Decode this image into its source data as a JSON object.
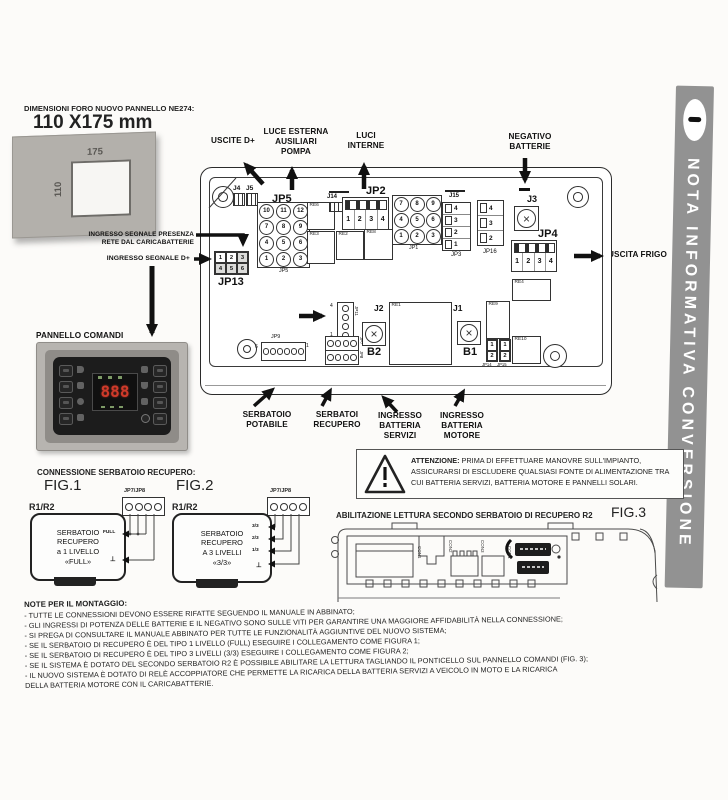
{
  "banner": {
    "title": "NOTA INFORMATIVA CONVERSIONE"
  },
  "colors": {
    "banner_bg": "#929292",
    "display_red": "#cf3a2a",
    "panel_black": "#1c1c1c",
    "frame_gray": "#b5b2ae",
    "ink": "#111111"
  },
  "dims": {
    "heading": "DIMENSIONI FORO NUOVO PANNELLO NE274:",
    "size": "110 X175 mm",
    "hole_w": "175",
    "hole_h": "110"
  },
  "callouts": {
    "uscite_d": "USCITE D+",
    "luce_esterna": "LUCE ESTERNA\nAUSILIARI\nPOMPA",
    "luci_interne": "LUCI\nINTERNE",
    "negativo_batterie": "NEGATIVO\nBATTERIE",
    "presenza": "INGRESSO SEGNALE PRESENZA\nRETE DAL CARICABATTERIE",
    "segnale_d": "INGRESSO SEGNALE D+",
    "uscita_frigo": "USCITA FRIGO",
    "cavo_seriale": "CAVO SERIALE",
    "pannello_comandi": "PANNELLO COMANDI",
    "serbatoio_potabile": "SERBATOIO\nPOTABILE",
    "serbatoi_recupero": "SERBATOI\nRECUPERO",
    "ingresso_batteria_servizi": "INGRESSO\nBATTERIA\nSERVIZI",
    "ingresso_batteria_motore": "INGRESSO\nBATTERIA\nMOTORE"
  },
  "board": {
    "j4": "J4",
    "j5": "J5",
    "jp5_big": "JP5",
    "jp5_small": "JP5",
    "jp5_cells": [
      "10",
      "11",
      "12",
      "7",
      "8",
      "9",
      "4",
      "5",
      "6",
      "1",
      "2",
      "3"
    ],
    "j14": "J14",
    "jp2": "JP2",
    "jp2_cells": [
      "1",
      "2",
      "3",
      "4"
    ],
    "jp1": "JP1",
    "jp1_cells": [
      "7",
      "8",
      "9",
      "4",
      "5",
      "6",
      "1",
      "2",
      "3"
    ],
    "j15": "J15",
    "jp3": "JP3",
    "jp3_cells": [
      "4",
      "3",
      "2",
      "1"
    ],
    "jp16": "JP16",
    "jp16_cells": [
      "4",
      "3",
      "2"
    ],
    "j3": "J3",
    "jp4": "JP4",
    "jp4_cells": [
      "1",
      "2",
      "3",
      "4"
    ],
    "re1": "RE1",
    "re2": "RE2",
    "re3": "RE3",
    "re4": "RE4",
    "re6": "RE6",
    "re8": "RE8",
    "re9": "RE9",
    "re10": "RE10",
    "jp13": "JP13",
    "jp13_cells": [
      "1",
      "2",
      "3",
      "4",
      "5",
      "6"
    ],
    "jp11": "JP11",
    "jp11_pin_top": "4",
    "jp11_pin_bottom": "1",
    "jp9": "JP9",
    "jp9_pin_left": "6",
    "jp9_pin_right": "1",
    "jp7": "JP7",
    "jp8": "JP8",
    "j2": "J2",
    "b2": "B2",
    "j1": "J1",
    "b1": "B1",
    "jp14": "JP14",
    "jp14_cells": [
      "1",
      "2"
    ],
    "jp15": "JP15",
    "jp15_cells": [
      "1",
      "2"
    ]
  },
  "panel": {
    "display": "888"
  },
  "warning": {
    "bold": "ATTENZIONE:",
    "rest": " PRIMA DI EFFETTUARE MANOVRE SULL'IMPIANTO, ASSICURARSI DI ESCLUDERE QUALSIASI FONTE DI ALIMENTAZIONE TRA CUI BATTERIA SERVIZI, BATTERIA MOTORE E PANNELLI SOLARI."
  },
  "figures": {
    "connessione_heading": "CONNESSIONE SERBATOIO RECUPERO:",
    "fig1": {
      "name": "FIG.1",
      "conn": "JP7/JP8",
      "ref": "R1/R2",
      "box": "SERBATOIO\nRECUPERO\na 1 LIVELLO\n«FULL»",
      "pin_full": "FULL",
      "pin_gnd": "⊥"
    },
    "fig2": {
      "name": "FIG.2",
      "conn": "JP7/JP8",
      "ref": "R1/R2",
      "box": "SERBATOIO\nRECUPERO\nA 3 LIVELLI\n«3/3»",
      "pin_33": "3/3",
      "pin_23": "2/3",
      "pin_13": "1/3",
      "pin_gnd": "⊥"
    },
    "fig3": {
      "name": "FIG.3",
      "heading": "ABILITAZIONE LETTURA SECONDO SERBATOIO DI RECUPERO R2",
      "con_labels": [
        "CON1",
        "CON2",
        "CON3",
        "CON4"
      ]
    }
  },
  "notes": {
    "heading": "NOTE PER IL MONTAGGIO:",
    "lines": [
      "- TUTTE LE CONNESSIONI DEVONO ESSERE RIFATTE SEGUENDO IL MANUALE IN ABBINATO;",
      "- GLI INGRESSI DI POTENZA DELLE BATTERIE E IL NEGATIVO SONO SULLE VITI PER GARANTIRE UNA MAGGIORE AFFIDABILITÀ NELLA CONNESSIONE;",
      "- SI PREGA DI CONSULTARE IL MANUALE ABBINATO PER TUTTE LE FUNZIONALITÀ AGGIUNTIVE DEL NUOVO SISTEMA;",
      "- SE IL SERBATOIO DI RECUPERO È DEL TIPO 1 LIVELLO (FULL) ESEGUIRE I COLLEGAMENTO COME FIGURA 1;",
      "- SE IL SERBATOIO DI RECUPERO È DEL TIPO 3 LIVELLI (3/3) ESEGUIRE I COLLEGAMENTO COME FIGURA 2;",
      "- SE IL SISTEMA È DOTATO DEL SECONDO SERBATOIO R2 È POSSIBILE ABILITARE LA LETTURA TAGLIANDO IL PONTICELLO SUL PANNELLO COMANDI (FIG. 3);",
      "- IL NUOVO SISTEMA È DOTATO DI RELÈ ACCOPPIATORE CHE PERMETTE LA RICARICA DELLA BATTERIA SERVIZI A VEICOLO IN MOTO E LA RICARICA",
      "DELLA BATTERIA MOTORE CON IL CARICABATTERIE."
    ]
  }
}
